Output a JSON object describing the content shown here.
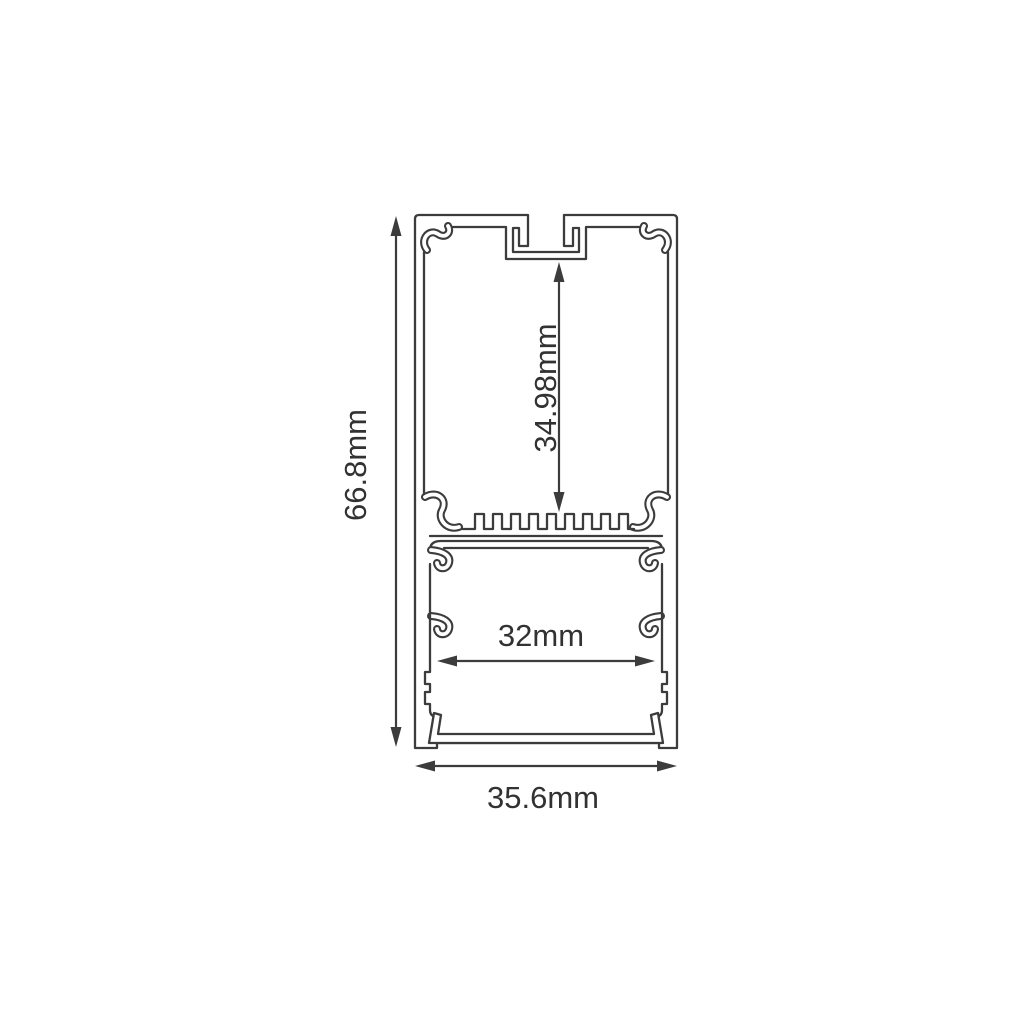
{
  "diagram": {
    "type": "led-profile-cross-section",
    "background": "#ffffff",
    "line_color": "#3c3c3c",
    "dimensions": {
      "overall_height": {
        "label": "66.8mm",
        "orientation": "vertical"
      },
      "inner_height": {
        "label": "34.98mm",
        "orientation": "vertical"
      },
      "inner_width": {
        "label": "32mm",
        "orientation": "horizontal"
      },
      "overall_width": {
        "label": "35.6mm",
        "orientation": "horizontal"
      }
    }
  }
}
